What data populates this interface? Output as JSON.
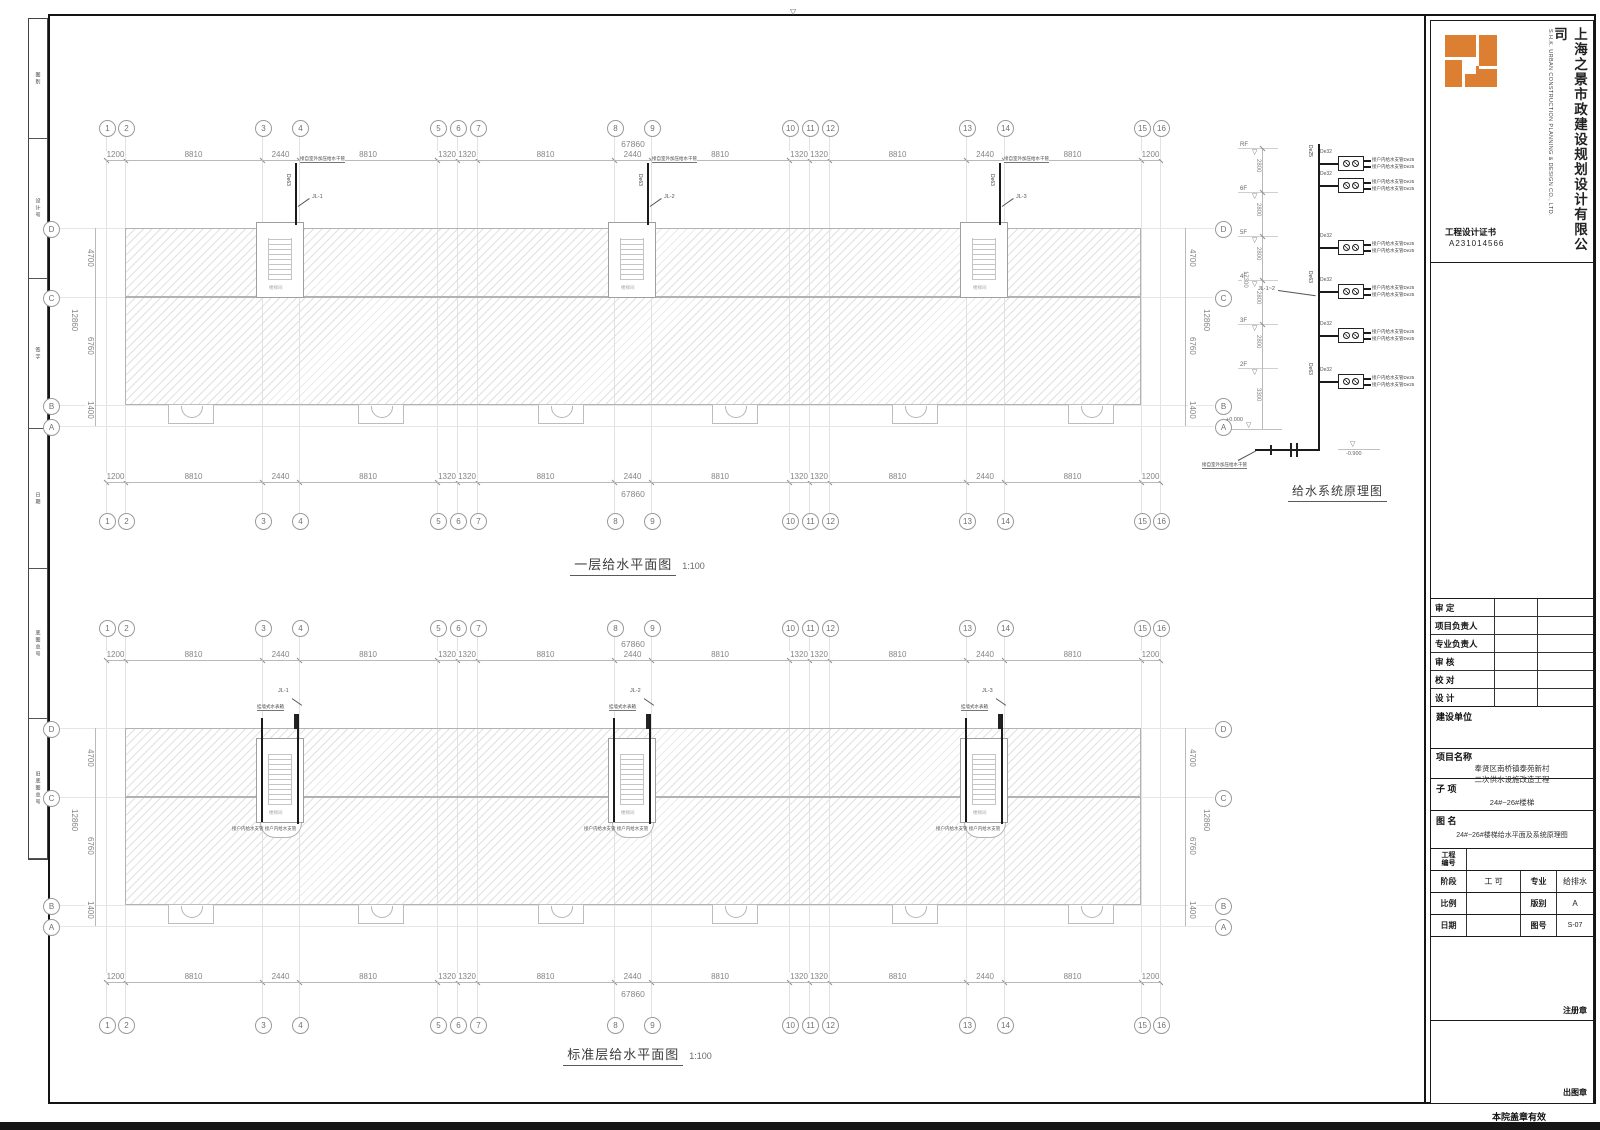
{
  "frame": {
    "fold_mark": "▽"
  },
  "left_strip": {
    "cells": [
      "图别",
      "设计号",
      "签字",
      "日期",
      "底图总号",
      "旧底图总号"
    ]
  },
  "title_block": {
    "company_cn": "上海之景市政建设规划设计有限公司",
    "company_en": "S.H.K. URBAN CONSTRUCTION PLANNING & DESIGN CO., LTD.",
    "cert_label": "工程设计证书",
    "cert_no": "A231014566",
    "signoff_rows": [
      "审  定",
      "项目负责人",
      "专业负责人",
      "审  核",
      "校  对",
      "设  计"
    ],
    "owner_label": "建设单位",
    "project_label": "项目名称",
    "project_name_1": "奉贤区南桥镇泰苑新村",
    "project_name_2": "二次供水设施改造工程",
    "subitem_label": "子  项",
    "subitem": "24#~26#楼梯",
    "drawing_label": "图  名",
    "drawing_name": "24#~26#楼梯给水平面及系统原理图",
    "eng_no_label_1": "工程",
    "eng_no_label_2": "编号",
    "stage_label": "阶段",
    "stage": "工 可",
    "major_label": "专业",
    "major": "给排水",
    "scale_label": "比例",
    "scale_val": "",
    "edition_label": "版别",
    "edition": "A",
    "date_label": "日期",
    "date_val": "",
    "fig_no_label": "图号",
    "fig_no": "S-07",
    "reg_seal": "注册章",
    "out_seal": "出图章",
    "valid_note": "本院盖章有效"
  },
  "plan_common": {
    "col_labels": [
      "1",
      "2",
      "3",
      "4",
      "5",
      "6",
      "7",
      "8",
      "9",
      "10",
      "11",
      "12",
      "13",
      "14",
      "15",
      "16"
    ],
    "dims": [
      "1200",
      "8810",
      "2440",
      "8810",
      "1320",
      "1320",
      "8810",
      "2440",
      "8810",
      "1320",
      "1320",
      "8810",
      "2440",
      "8810",
      "1200"
    ],
    "total": "67860",
    "row_labels": [
      "D",
      "C",
      "B",
      "A"
    ],
    "row_dims": [
      "4700",
      "6760",
      "1400"
    ],
    "row_total": "12860",
    "riser_ids": [
      "JL-1",
      "JL-2",
      "JL-3"
    ],
    "riser_pipe": "De63",
    "supply_note": "接自室外加压给水干管",
    "stair_room": "楼梯间",
    "meter_box_label": "挂墙式水表箱",
    "branch_label": "接户内给水支管 接户内给水支管"
  },
  "plans": [
    {
      "title": "一层给水平面图",
      "scale": "1:100"
    },
    {
      "title": "标准层给水平面图",
      "scale": "1:100"
    }
  ],
  "schematic": {
    "title": "给水系统原理图",
    "floors": [
      "RF",
      "6F",
      "5F",
      "4F",
      "3F",
      "2F"
    ],
    "floor_dims": [
      "2800",
      "2800",
      "2800",
      "2800",
      "2800"
    ],
    "bottom_dim": "3300",
    "total_dim": "17300",
    "riser_top_pipe": "De25",
    "riser_mid_pipe": "De63",
    "branch_pipe": "De32",
    "branch_label": "接户内给水支管De25",
    "riser_id": "JL-1~2",
    "ground_level": "+0.000",
    "base_level": "-0.900",
    "source_note": "接自室外加压给水干管",
    "level_mark": "▽"
  }
}
